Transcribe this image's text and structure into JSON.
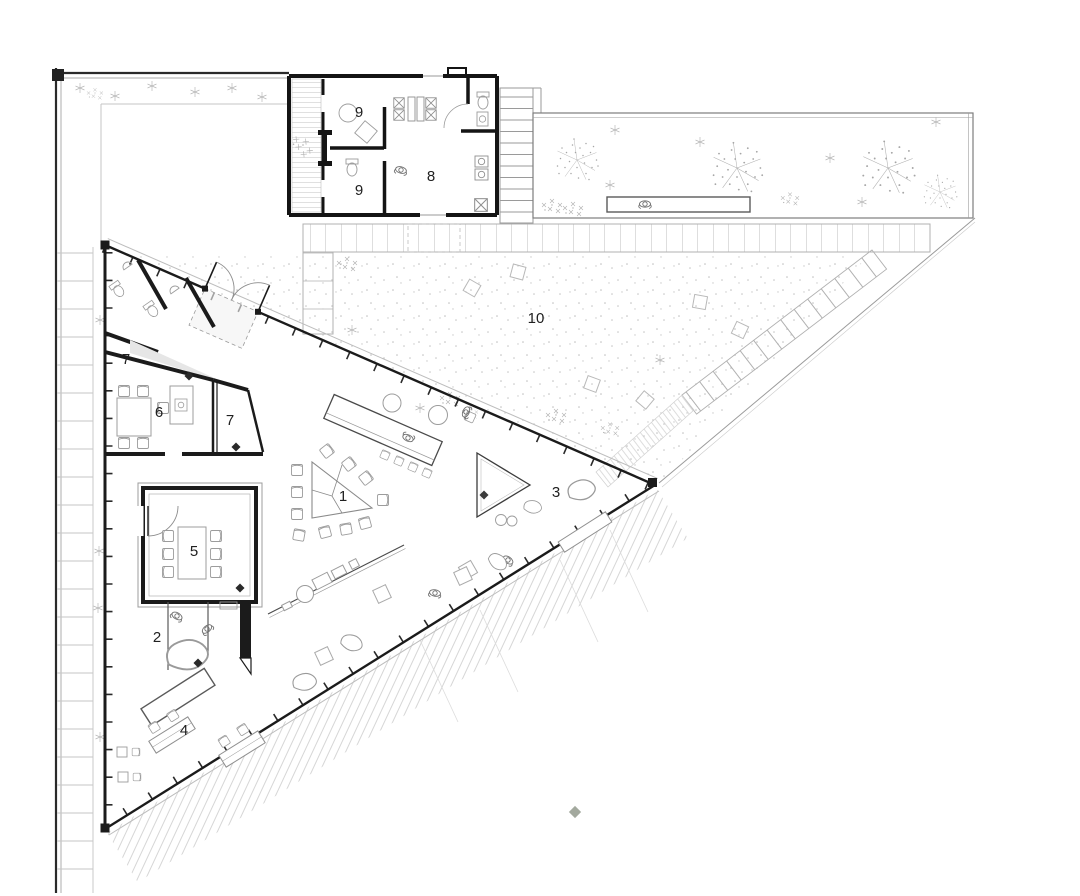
{
  "drawing": {
    "kind": "architectural ground floor / site plan",
    "style": "black and grey linework on white"
  },
  "colors": {
    "wall": "#1b1b1b",
    "mid_line": "#8c8c8c",
    "light_line": "#c0c0c0",
    "gray_fill": "#e6e6e6",
    "site_marker": "#a3a99e",
    "background": "#ffffff"
  },
  "labels": [
    {
      "id": "annex-room-9-upper",
      "text": "9"
    },
    {
      "id": "annex-room-9-lower",
      "text": "9"
    },
    {
      "id": "annex-room-8",
      "text": "8"
    },
    {
      "id": "courtyard-10",
      "text": "10"
    },
    {
      "id": "room-7-upper",
      "text": "7"
    },
    {
      "id": "room-6",
      "text": "6"
    },
    {
      "id": "room-7-right",
      "text": "7"
    },
    {
      "id": "room-5",
      "text": "5"
    },
    {
      "id": "hall-1",
      "text": "1"
    },
    {
      "id": "room-2",
      "text": "2"
    },
    {
      "id": "room-3",
      "text": "3"
    },
    {
      "id": "room-4",
      "text": "4"
    }
  ]
}
